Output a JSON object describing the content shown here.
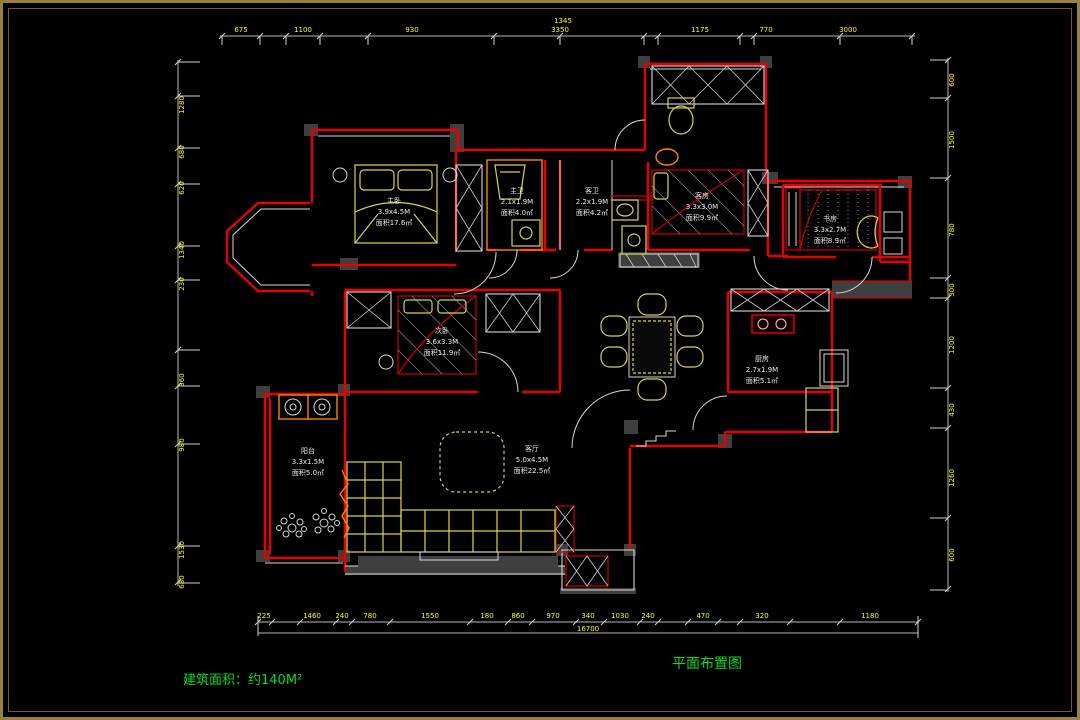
{
  "title_block": {
    "area_text": "建筑面积：约140M²",
    "drawing_title": "平面布置图"
  },
  "rooms": [
    {
      "id": "master-bedroom",
      "name": "主卧",
      "dims": "3.9x4.5M",
      "area": "面积17.6㎡"
    },
    {
      "id": "master-bath",
      "name": "主卫",
      "dims": "2.1x1.9M",
      "area": "面积4.0㎡"
    },
    {
      "id": "guest-bath",
      "name": "客卫",
      "dims": "2.2x1.9M",
      "area": "面积4.2㎡"
    },
    {
      "id": "guest-room",
      "name": "客房",
      "dims": "3.3x3.0M",
      "area": "面积9.9㎡"
    },
    {
      "id": "study-room",
      "name": "书房",
      "dims": "3.3x2.7M",
      "area": "面积8.9㎡"
    },
    {
      "id": "bedroom-2",
      "name": "次卧",
      "dims": "3.6x3.3M",
      "area": "面积11.9㎡"
    },
    {
      "id": "kitchen",
      "name": "厨房",
      "dims": "2.7x1.9M",
      "area": "面积5.1㎡"
    },
    {
      "id": "living-room",
      "name": "客厅",
      "dims": "5.0x4.5M",
      "area": "面积22.5㎡"
    },
    {
      "id": "balcony",
      "name": "阳台",
      "dims": "3.3x1.5M",
      "area": "面积5.0㎡"
    }
  ],
  "dimensions": {
    "top": [
      "675",
      "1100",
      "930",
      "3350",
      "1175",
      "770",
      "3000"
    ],
    "top_total": "1345",
    "bottom": [
      "225",
      "1460",
      "240",
      "780",
      "1550",
      "180",
      "860",
      "970",
      "340",
      "1030",
      "240",
      "470",
      "320",
      "1180"
    ],
    "bottom_total": "16700",
    "left": [
      "1280",
      "680",
      "620",
      "1340",
      "230",
      "360",
      "980",
      "1530",
      "680"
    ],
    "right": [
      "600",
      "1500",
      "780",
      "300",
      "1200",
      "430",
      "1260",
      "600"
    ]
  },
  "colors": {
    "background": "#000000",
    "frame_gold": "#97803c",
    "wall_red": "#e60000",
    "furniture_yellow": "#d8d448",
    "dim_text": "#ffff00",
    "label_white": "#ececec",
    "annotation_green": "#00dd22",
    "fixture_orange": "#ff8400",
    "wall_gray": "#3f3f3f"
  }
}
